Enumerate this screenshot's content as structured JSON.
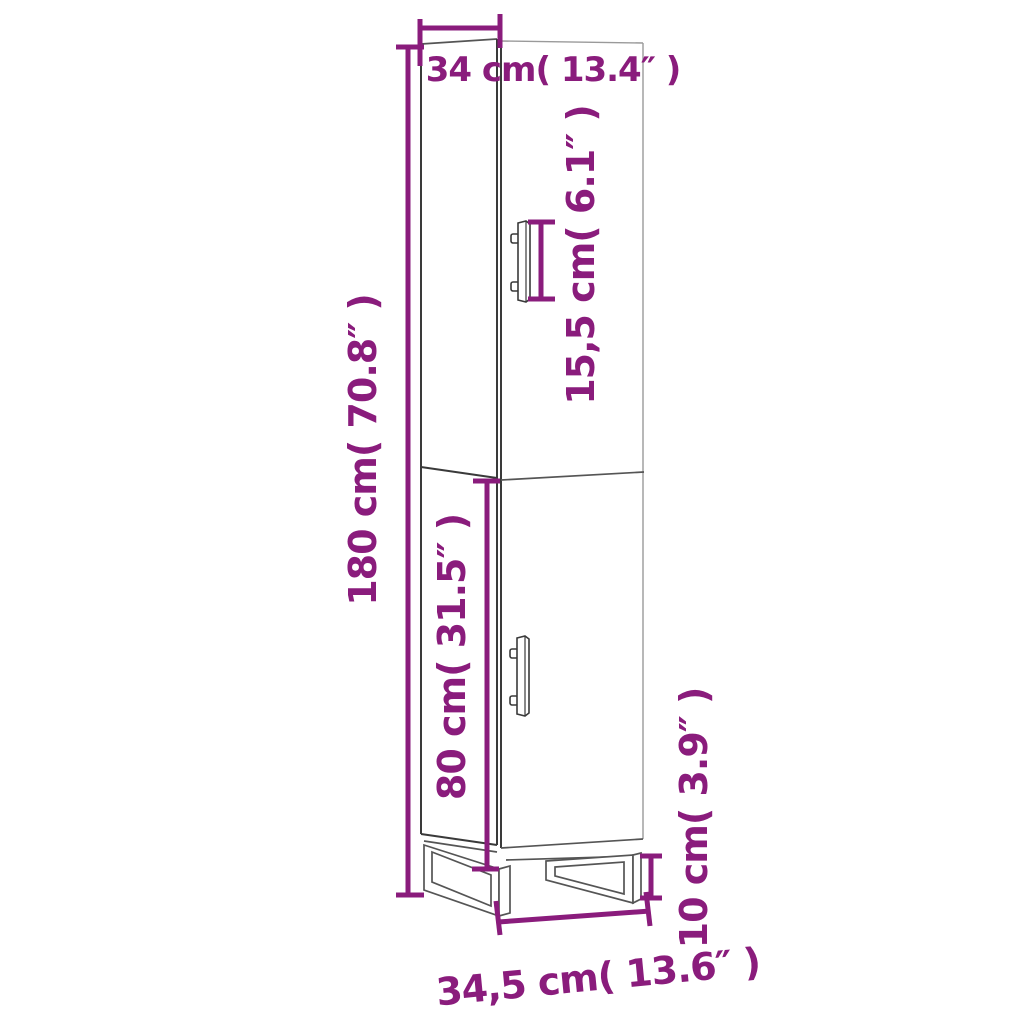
{
  "diagram": {
    "title": "Tall cabinet dimension diagram",
    "colors": {
      "accent": "#8A1C7C",
      "line_dark": "#3A3A3A",
      "line_mid": "#555555",
      "line_light": "#9A9A9A",
      "background": "#FFFFFF"
    },
    "dimensions": {
      "width_top": "34 cm( 13.4″ )",
      "handle_height": "15,5 cm( 6.1″ )",
      "total_height": "180 cm( 70.8″ )",
      "lower_door_height": "80 cm( 31.5″ )",
      "leg_height": "10 cm( 3.9″ )",
      "depth_bottom": "34,5 cm( 13.6″ )"
    }
  }
}
